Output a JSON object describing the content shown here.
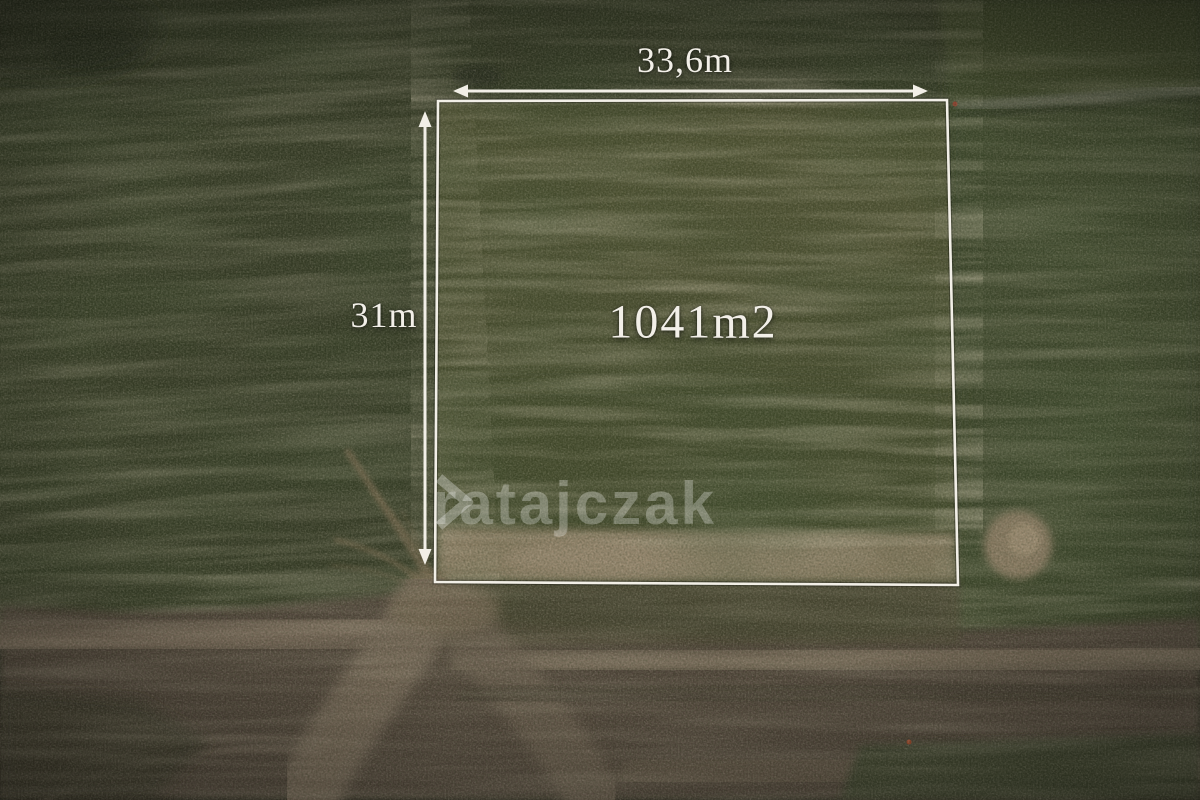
{
  "photo": {
    "description": "Aerial drone photograph of farmland: a rectangular plot for sale outlined in white in a dark green field, sandy strip along its bottom edge, dirt roads and a road junction in the lower part of the frame",
    "width_label": "33,6m",
    "height_label": "31m",
    "area_label": "1041m2"
  },
  "watermark": {
    "text": "ratajczak",
    "icon": "chevron-right-icon"
  },
  "colors": {
    "annotation_white": "#f2efe7",
    "field_green_dark": "#333a25",
    "plot_green": "#4a4e2f",
    "right_field_green": "#3b442b",
    "dirt_brown": "#4e4339",
    "road_light_brown": "#6a5d4f",
    "sand_tan": "#93836b",
    "watermark_white": "rgba(255,255,255,0.28)"
  }
}
